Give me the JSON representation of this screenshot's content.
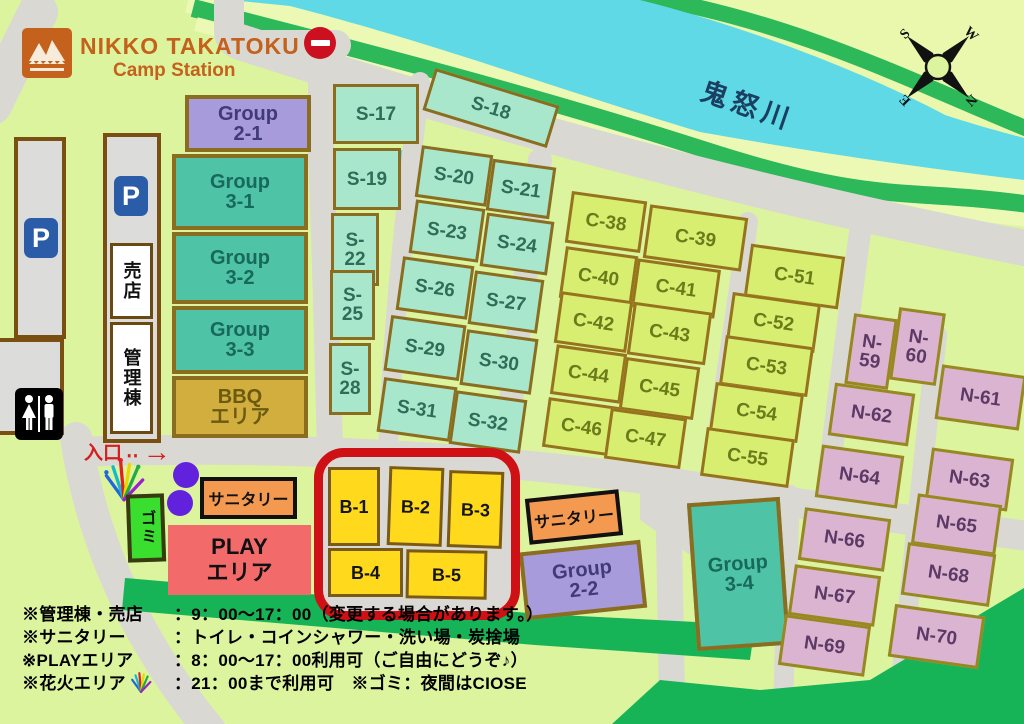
{
  "header": {
    "logo_title": "NIKKO TAKATOKU",
    "logo_subtitle": "Camp Station"
  },
  "river": {
    "label": "鬼怒川"
  },
  "compass": {
    "s": "S",
    "w": "W",
    "e": "E",
    "n": "N"
  },
  "facilities": {
    "parking_label": "P",
    "shop": "売店",
    "office": "管理棟",
    "entrance": "入口",
    "entrance_dots": "‥",
    "entrance_arrow": "→",
    "trash": "ゴミ",
    "sanitary_1": "サニタリー",
    "sanitary_2": "サニタリー",
    "play_l1": "PLAY",
    "play_l2": "エリア"
  },
  "sites": {
    "s": [
      {
        "id": "S-17",
        "x": 333,
        "y": 84,
        "w": 86,
        "h": 60,
        "r": 0
      },
      {
        "id": "S-19",
        "x": 333,
        "y": 148,
        "w": 68,
        "h": 62,
        "r": 0
      },
      {
        "id": "S-22",
        "x": 331,
        "y": 213,
        "w": 48,
        "h": 73,
        "r": 0,
        "tl": 1
      },
      {
        "id": "S-25",
        "x": 330,
        "y": 270,
        "w": 45,
        "h": 70,
        "r": 0,
        "tl": 1
      },
      {
        "id": "S-28",
        "x": 329,
        "y": 343,
        "w": 42,
        "h": 72,
        "r": 0,
        "tl": 1
      },
      {
        "id": "S-18",
        "x": 426,
        "y": 86,
        "w": 130,
        "h": 44,
        "r": 17
      },
      {
        "id": "S-20",
        "x": 418,
        "y": 150,
        "w": 72,
        "h": 52,
        "r": 8
      },
      {
        "id": "S-21",
        "x": 489,
        "y": 163,
        "w": 64,
        "h": 52,
        "r": 8
      },
      {
        "id": "S-23",
        "x": 412,
        "y": 204,
        "w": 70,
        "h": 54,
        "r": 8
      },
      {
        "id": "S-24",
        "x": 483,
        "y": 217,
        "w": 68,
        "h": 54,
        "r": 8
      },
      {
        "id": "S-26",
        "x": 399,
        "y": 261,
        "w": 72,
        "h": 54,
        "r": 8
      },
      {
        "id": "S-27",
        "x": 471,
        "y": 275,
        "w": 70,
        "h": 54,
        "r": 8
      },
      {
        "id": "S-29",
        "x": 387,
        "y": 320,
        "w": 76,
        "h": 56,
        "r": 8
      },
      {
        "id": "S-30",
        "x": 463,
        "y": 334,
        "w": 72,
        "h": 56,
        "r": 8
      },
      {
        "id": "S-31",
        "x": 380,
        "y": 382,
        "w": 74,
        "h": 55,
        "r": 8
      },
      {
        "id": "S-32",
        "x": 452,
        "y": 395,
        "w": 72,
        "h": 54,
        "r": 8
      }
    ],
    "c": [
      {
        "id": "C-38",
        "x": 568,
        "y": 196,
        "w": 76,
        "h": 52,
        "r": 8
      },
      {
        "id": "C-39",
        "x": 646,
        "y": 211,
        "w": 99,
        "h": 54,
        "r": 8
      },
      {
        "id": "C-40",
        "x": 562,
        "y": 251,
        "w": 73,
        "h": 52,
        "r": 8
      },
      {
        "id": "C-41",
        "x": 634,
        "y": 264,
        "w": 84,
        "h": 49,
        "r": 8
      },
      {
        "id": "C-42",
        "x": 557,
        "y": 296,
        "w": 73,
        "h": 52,
        "r": 8
      },
      {
        "id": "C-43",
        "x": 630,
        "y": 307,
        "w": 79,
        "h": 53,
        "r": 8
      },
      {
        "id": "C-44",
        "x": 553,
        "y": 349,
        "w": 71,
        "h": 50,
        "r": 8
      },
      {
        "id": "C-45",
        "x": 622,
        "y": 362,
        "w": 75,
        "h": 53,
        "r": 8
      },
      {
        "id": "C-46",
        "x": 545,
        "y": 402,
        "w": 73,
        "h": 50,
        "r": 8
      },
      {
        "id": "C-47",
        "x": 607,
        "y": 413,
        "w": 77,
        "h": 51,
        "r": 8
      },
      {
        "id": "C-51",
        "x": 747,
        "y": 250,
        "w": 95,
        "h": 53,
        "r": 8
      },
      {
        "id": "C-52",
        "x": 729,
        "y": 298,
        "w": 89,
        "h": 49,
        "r": 8
      },
      {
        "id": "C-53",
        "x": 722,
        "y": 341,
        "w": 89,
        "h": 50,
        "r": 8
      },
      {
        "id": "C-54",
        "x": 712,
        "y": 388,
        "w": 89,
        "h": 49,
        "r": 8
      },
      {
        "id": "C-55",
        "x": 703,
        "y": 433,
        "w": 89,
        "h": 49,
        "r": 8
      }
    ],
    "n": [
      {
        "id": "N-59",
        "x": 849,
        "y": 316,
        "w": 44,
        "h": 71,
        "r": 8,
        "tl": 1
      },
      {
        "id": "N-60",
        "x": 894,
        "y": 310,
        "w": 47,
        "h": 73,
        "r": 8,
        "tl": 1
      },
      {
        "id": "N-61",
        "x": 938,
        "y": 370,
        "w": 85,
        "h": 55,
        "r": 8
      },
      {
        "id": "N-62",
        "x": 831,
        "y": 388,
        "w": 81,
        "h": 53,
        "r": 8
      },
      {
        "id": "N-63",
        "x": 928,
        "y": 453,
        "w": 83,
        "h": 53,
        "r": 8
      },
      {
        "id": "N-64",
        "x": 818,
        "y": 450,
        "w": 83,
        "h": 53,
        "r": 8
      },
      {
        "id": "N-65",
        "x": 914,
        "y": 499,
        "w": 85,
        "h": 51,
        "r": 8
      },
      {
        "id": "N-66",
        "x": 801,
        "y": 513,
        "w": 87,
        "h": 53,
        "r": 8
      },
      {
        "id": "N-67",
        "x": 791,
        "y": 570,
        "w": 87,
        "h": 51,
        "r": 8
      },
      {
        "id": "N-68",
        "x": 904,
        "y": 548,
        "w": 89,
        "h": 53,
        "r": 8
      },
      {
        "id": "N-69",
        "x": 781,
        "y": 620,
        "w": 87,
        "h": 51,
        "r": 8
      },
      {
        "id": "N-70",
        "x": 891,
        "y": 610,
        "w": 91,
        "h": 53,
        "r": 8
      }
    ],
    "b": [
      {
        "id": "B-1",
        "x": 328,
        "y": 467,
        "w": 52,
        "h": 79,
        "r": 0
      },
      {
        "id": "B-2",
        "x": 388,
        "y": 467,
        "w": 55,
        "h": 79,
        "r": 2
      },
      {
        "id": "B-3",
        "x": 448,
        "y": 471,
        "w": 55,
        "h": 77,
        "r": 2
      },
      {
        "id": "B-4",
        "x": 328,
        "y": 548,
        "w": 75,
        "h": 49,
        "r": 0
      },
      {
        "id": "B-5",
        "x": 406,
        "y": 550,
        "w": 81,
        "h": 49,
        "r": 1
      }
    ],
    "groups": [
      {
        "l1": "Group",
        "l2": "2-1",
        "x": 185,
        "y": 95,
        "w": 126,
        "h": 57,
        "r": 0,
        "cls": "purple"
      },
      {
        "l1": "Group",
        "l2": "3-1",
        "x": 172,
        "y": 154,
        "w": 136,
        "h": 76,
        "r": 0,
        "cls": "teal"
      },
      {
        "l1": "Group",
        "l2": "3-2",
        "x": 172,
        "y": 232,
        "w": 136,
        "h": 72,
        "r": 0,
        "cls": "teal"
      },
      {
        "l1": "Group",
        "l2": "3-3",
        "x": 172,
        "y": 306,
        "w": 136,
        "h": 68,
        "r": 0,
        "cls": "teal"
      },
      {
        "l1": "BBQ",
        "l2": "エリア",
        "x": 172,
        "y": 376,
        "w": 136,
        "h": 62,
        "r": 0,
        "cls": "gold"
      },
      {
        "l1": "Group",
        "l2": "2-2",
        "x": 522,
        "y": 546,
        "w": 122,
        "h": 68,
        "r": -6,
        "cls": "purple"
      },
      {
        "l1": "Group",
        "l2": "3-4",
        "x": 692,
        "y": 500,
        "w": 93,
        "h": 148,
        "r": -4,
        "cls": "teal"
      }
    ]
  },
  "notes": [
    {
      "label": "※管理棟・売店",
      "value": "：9：00～17：00（変更する場合があります。）"
    },
    {
      "label": "※サニタリー",
      "value": "：トイレ・コインシャワー・洗い場・炭捨場"
    },
    {
      "label": "※PLAYエリア",
      "value": "：8：00～17：00利用可（ご自由にどうぞ♪）"
    },
    {
      "label": "※花火エリア",
      "has_icon": true,
      "value": "：21：00まで利用可　※ゴミ：夜間はCIOSE"
    }
  ],
  "colors": {
    "bg": "#ddf49e",
    "road": "#d9d8d3",
    "river": "#5fd9e6",
    "bank": "#2db85a",
    "pale": "#ecf9b4",
    "green": "#16b457",
    "s": "#a9e7cd",
    "sText": "#2e6e58",
    "c": "#d7ee71",
    "cText": "#6d7a1a",
    "n": "#dab4d0",
    "nText": "#5d3a66",
    "b": "#ffd91c",
    "group_purple": "#a79bdb",
    "group_teal": "#4fc3a6",
    "bbq": "#d2ae3e",
    "sanitary": "#f49a50",
    "play": "#f26a6a",
    "trash": "#3ade2e",
    "red": "#cf1115",
    "accent": "#c4611c"
  }
}
